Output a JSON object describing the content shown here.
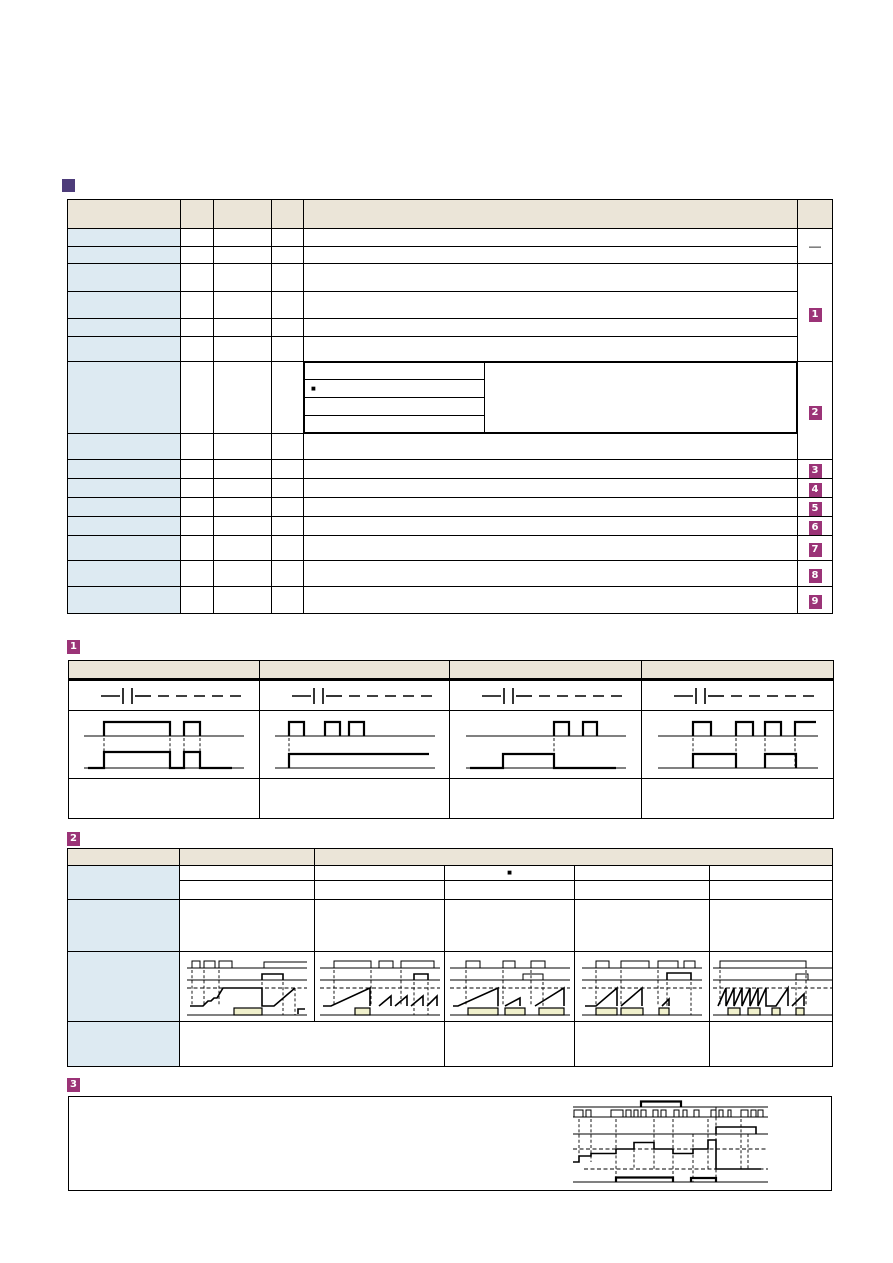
{
  "page": {
    "width": 893,
    "height": 1263,
    "background": "#ffffff"
  },
  "palette": {
    "table_header_fill": "#ebe5d8",
    "row_header_fill": "#ddeaf2",
    "footnote_badge_fill": "#9b3377",
    "footnote_badge_text": "#ffffff",
    "section_marker_fill": "#4d3c7a",
    "waveform_highlight_fill": "#f0f0cc",
    "line_color": "#000000"
  },
  "heading": {
    "marker_icon": "square"
  },
  "main_table": {
    "column_count": 6,
    "body_row_count": 15,
    "reference_column": {
      "dash": "—",
      "badges": [
        "1",
        "2",
        "3",
        "4",
        "5",
        "6",
        "7",
        "8",
        "9"
      ]
    },
    "nested_table": {
      "row_count": 4,
      "bullet": "■"
    }
  },
  "sections": {
    "s1": {
      "badge": "1",
      "column_count": 4
    },
    "s2": {
      "badge": "2",
      "column_count": 6,
      "subheader_bullet": "■"
    },
    "s3": {
      "badge": "3"
    }
  }
}
